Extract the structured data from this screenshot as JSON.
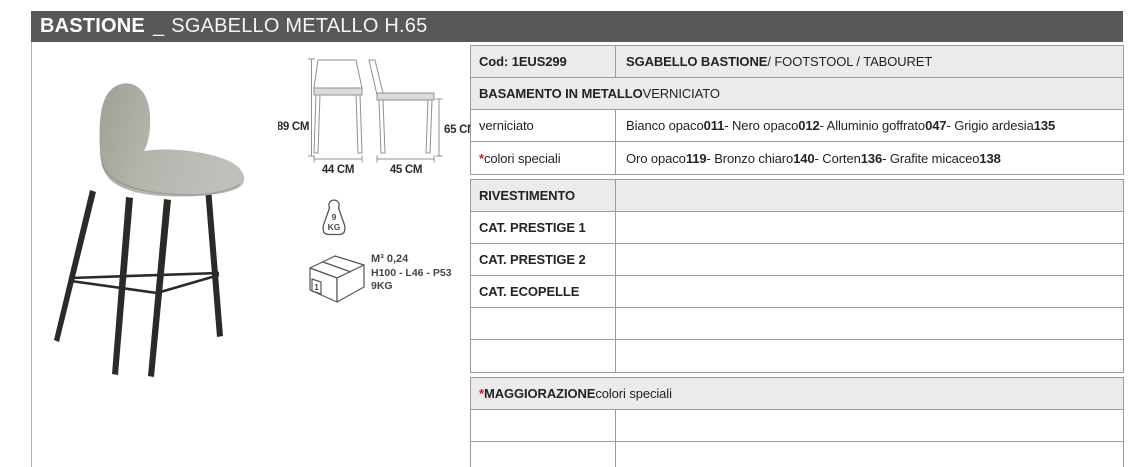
{
  "title": {
    "brand": "BASTIONE",
    "separator": "_",
    "subtitle": "SGABELLO METALLO H.65"
  },
  "colors": {
    "title_bar_bg": "#57585a",
    "row_gray_bg": "#ebebec",
    "table_border": "#9c9c9e",
    "accent_red": "#c42127",
    "text": "#232323",
    "seat_fabric": "#aeb1a8",
    "metal_legs": "#2b2a27"
  },
  "icons": {
    "weight": "weight-kg-icon",
    "package": "package-box-icon",
    "drawings": [
      "stool-front-view-drawing",
      "stool-side-view-drawing"
    ]
  },
  "dims": {
    "total_height": "89 CM",
    "width": "44 CM",
    "seat_height": "65 CM",
    "depth": "45 CM"
  },
  "weight": {
    "value": "9",
    "unit": "KG"
  },
  "packaging": {
    "count": "1",
    "volume": "M³ 0,24",
    "box_size": "H100 - L46 - P53",
    "weight": "9KG"
  },
  "table": {
    "rows": [
      {
        "label": [
          {
            "t": "Cod: 1EUS299",
            "b": true
          }
        ],
        "value": [
          {
            "t": "SGABELLO BASTIONE",
            "b": true
          },
          {
            "t": " / FOOTSTOOL / TABOURET"
          }
        ]
      },
      {
        "label": [
          {
            "t": "BASAMENTO IN METALLO",
            "b": true
          },
          {
            "t": " VERNICIATO"
          }
        ],
        "value": []
      },
      {
        "label": [
          {
            "t": "verniciato"
          }
        ],
        "value": [
          {
            "t": "Bianco opaco "
          },
          {
            "t": "011",
            "b": true
          },
          {
            "t": " - Nero opaco "
          },
          {
            "t": "012",
            "b": true
          },
          {
            "t": " - Alluminio goffrato "
          },
          {
            "t": "047",
            "b": true
          },
          {
            "t": " - Grigio ardesia "
          },
          {
            "t": "135",
            "b": true
          }
        ]
      },
      {
        "label": [
          {
            "t": "* ",
            "b": true,
            "r": true
          },
          {
            "t": "colori speciali"
          }
        ],
        "value": [
          {
            "t": "Oro opaco "
          },
          {
            "t": "119",
            "b": true
          },
          {
            "t": " - Bronzo chiaro "
          },
          {
            "t": "140",
            "b": true
          },
          {
            "t": " - Corten "
          },
          {
            "t": "136",
            "b": true
          },
          {
            "t": " - Grafite micaceo "
          },
          {
            "t": "138",
            "b": true
          }
        ]
      },
      {
        "label": [
          {
            "t": "RIVESTIMENTO",
            "b": true
          }
        ],
        "value": []
      },
      {
        "label": [
          {
            "t": "CAT. PRESTIGE 1",
            "b": true
          }
        ],
        "value": []
      },
      {
        "label": [
          {
            "t": "CAT. PRESTIGE 2",
            "b": true
          }
        ],
        "value": []
      },
      {
        "label": [
          {
            "t": "CAT. ECOPELLE",
            "b": true
          }
        ],
        "value": []
      },
      {
        "label": [],
        "value": []
      },
      {
        "label": [],
        "value": []
      },
      {
        "label": [
          {
            "t": "*",
            "b": true,
            "r": true
          },
          {
            "t": "MAGGIORAZIONE",
            "b": true
          },
          {
            "t": " colori speciali"
          }
        ],
        "value": []
      },
      {
        "label": [],
        "value": []
      },
      {
        "label": [],
        "value": []
      }
    ]
  }
}
